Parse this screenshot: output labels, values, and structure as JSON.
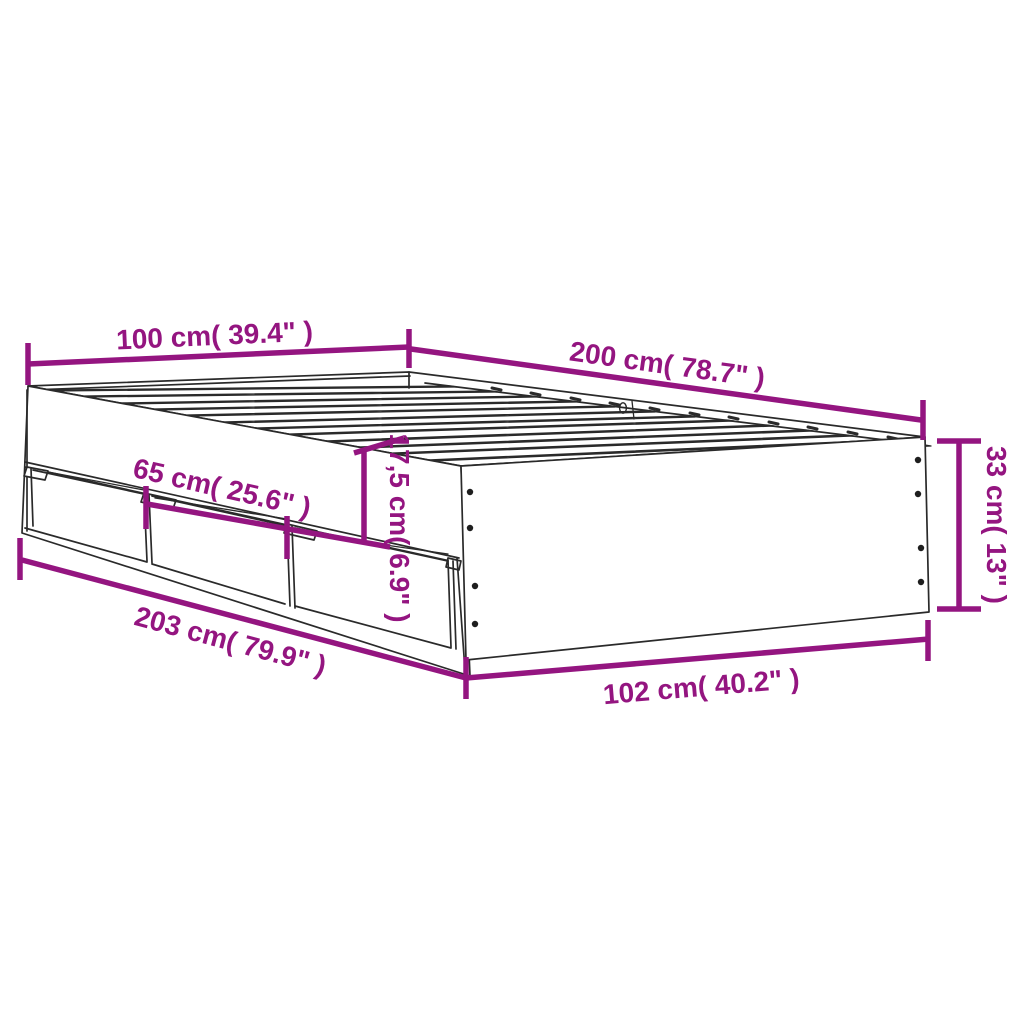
{
  "diagram": {
    "kind": "product dimension diagram",
    "subject": "bed frame with slatted base and three storage drawers",
    "accent_color": "#941580",
    "line_color": "#2a2a2a",
    "hole_color": "#1e1e1e",
    "background": "#ffffff",
    "labels": {
      "head_width": "100 cm( 39.4\" )",
      "frame_length": "200 cm( 78.7\" )",
      "frame_height": "33 cm( 13\" )",
      "drawer_width": "65 cm( 25.6\" )",
      "rail_height": "17,5 cm( 6.9\" )",
      "overall_length": "203 cm( 79.9\" )",
      "overall_width": "102 cm( 40.2\" )"
    }
  }
}
